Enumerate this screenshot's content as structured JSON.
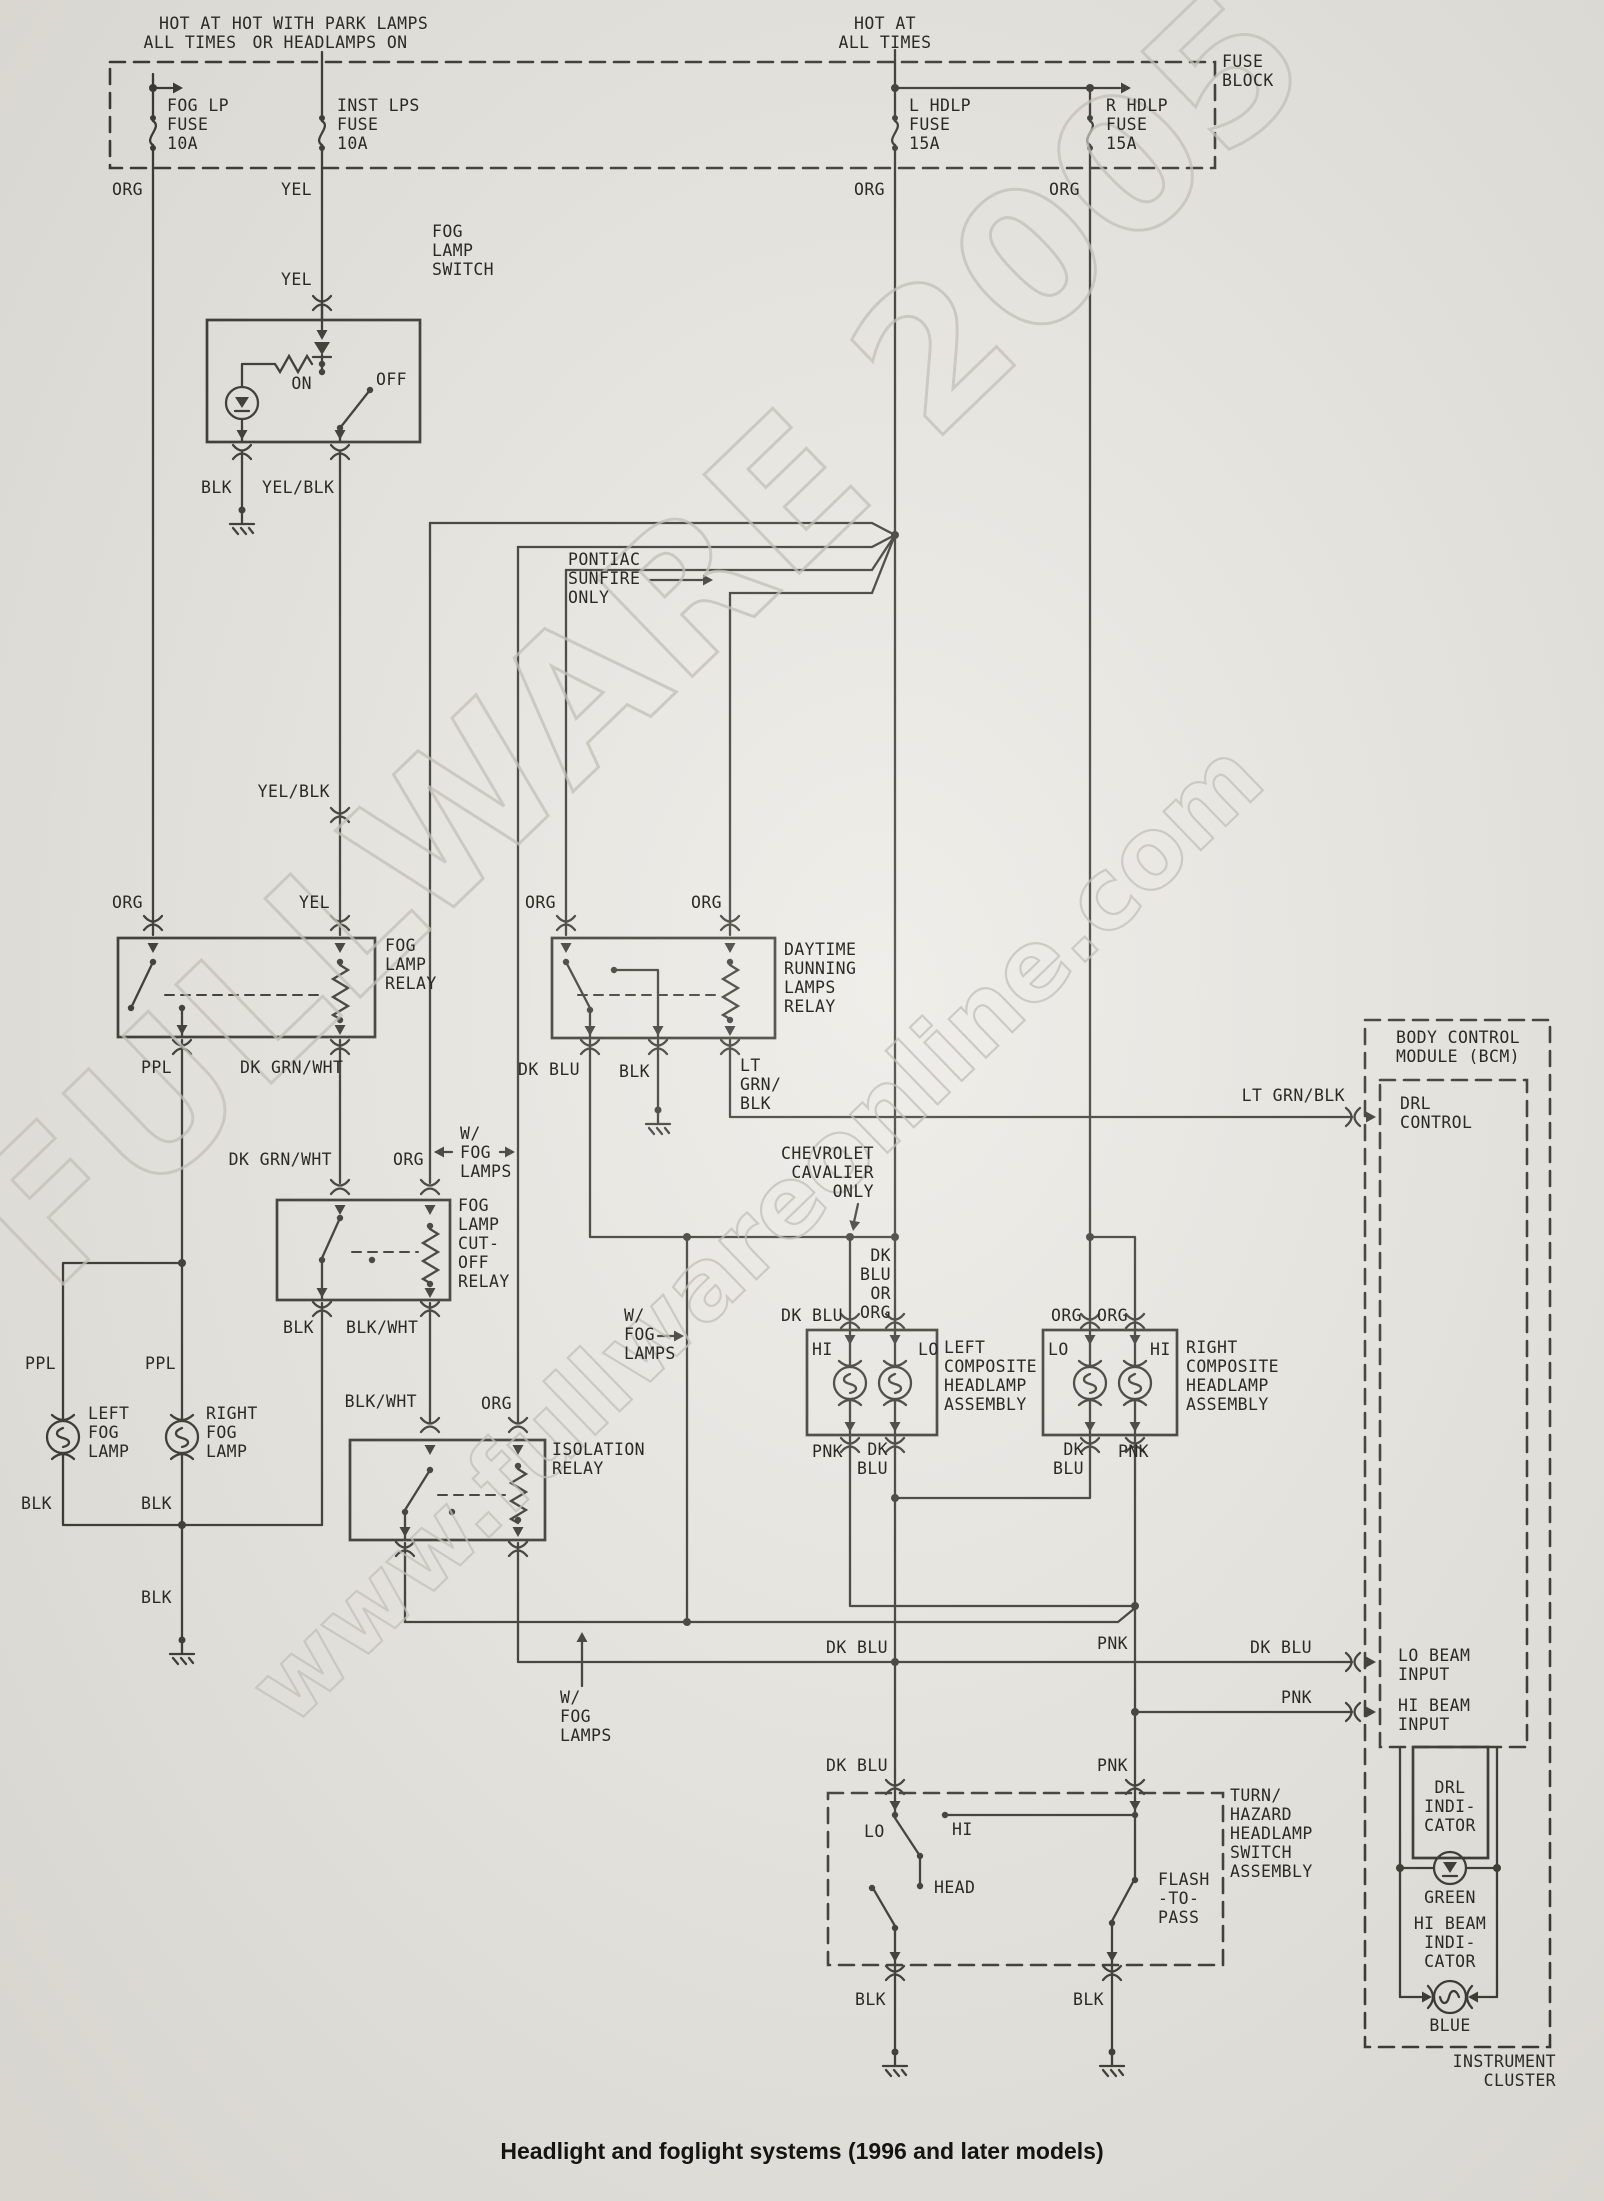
{
  "caption": "Headlight and foglight systems (1996 and later models)",
  "watermark": {
    "primary": "FULLWARE 2005",
    "secondary": "www.fullwareonline.com"
  },
  "colors": {
    "paper": "#eae8e2",
    "ink": "#26261f",
    "watermark": "#c2c1b8"
  },
  "labels": [
    {
      "t": "HOT AT\nALL TIMES",
      "x": 190,
      "y": 14,
      "a": "c"
    },
    {
      "t": "HOT WITH PARK LAMPS\nOR HEADLAMPS ON",
      "x": 330,
      "y": 14,
      "a": "c"
    },
    {
      "t": "HOT AT\nALL TIMES",
      "x": 885,
      "y": 14,
      "a": "c"
    },
    {
      "t": "FUSE\nBLOCK",
      "x": 1222,
      "y": 52,
      "a": "l"
    },
    {
      "t": "FOG LP\nFUSE\n10A",
      "x": 167,
      "y": 96,
      "a": "l"
    },
    {
      "t": "INST LPS\nFUSE\n10A",
      "x": 337,
      "y": 96,
      "a": "l"
    },
    {
      "t": "L HDLP\nFUSE\n15A",
      "x": 909,
      "y": 96,
      "a": "l"
    },
    {
      "t": "R HDLP\nFUSE\n15A",
      "x": 1106,
      "y": 96,
      "a": "l"
    },
    {
      "t": "ORG",
      "x": 143,
      "y": 180,
      "a": "r"
    },
    {
      "t": "YEL",
      "x": 312,
      "y": 180,
      "a": "r"
    },
    {
      "t": "ORG",
      "x": 885,
      "y": 180,
      "a": "r"
    },
    {
      "t": "ORG",
      "x": 1080,
      "y": 180,
      "a": "r"
    },
    {
      "t": "YEL",
      "x": 312,
      "y": 270,
      "a": "r"
    },
    {
      "t": "FOG\nLAMP\nSWITCH",
      "x": 432,
      "y": 222,
      "a": "l"
    },
    {
      "t": "ON",
      "x": 312,
      "y": 374,
      "a": "r"
    },
    {
      "t": "OFF",
      "x": 376,
      "y": 370,
      "a": "l"
    },
    {
      "t": "BLK",
      "x": 232,
      "y": 478,
      "a": "r"
    },
    {
      "t": "YEL/BLK",
      "x": 262,
      "y": 478,
      "a": "l"
    },
    {
      "t": "YEL/BLK",
      "x": 330,
      "y": 782,
      "a": "r"
    },
    {
      "t": "ORG",
      "x": 143,
      "y": 893,
      "a": "r"
    },
    {
      "t": "YEL",
      "x": 330,
      "y": 893,
      "a": "r"
    },
    {
      "t": "FOG\nLAMP\nRELAY",
      "x": 385,
      "y": 936,
      "a": "l"
    },
    {
      "t": "PPL",
      "x": 172,
      "y": 1058,
      "a": "r"
    },
    {
      "t": "DK GRN/WHT",
      "x": 240,
      "y": 1058,
      "a": "l"
    },
    {
      "t": "PONTIAC\nSUNFIRE\nONLY",
      "x": 568,
      "y": 550,
      "a": "l"
    },
    {
      "t": "ORG",
      "x": 556,
      "y": 893,
      "a": "r"
    },
    {
      "t": "ORG",
      "x": 722,
      "y": 893,
      "a": "r"
    },
    {
      "t": "DAYTIME\nRUNNING\nLAMPS\nRELAY",
      "x": 784,
      "y": 940,
      "a": "l"
    },
    {
      "t": "DK BLU",
      "x": 580,
      "y": 1060,
      "a": "r"
    },
    {
      "t": "BLK",
      "x": 650,
      "y": 1062,
      "a": "r"
    },
    {
      "t": "LT\nGRN/\nBLK",
      "x": 740,
      "y": 1056,
      "a": "l"
    },
    {
      "t": "LT GRN/BLK",
      "x": 1345,
      "y": 1086,
      "a": "r"
    },
    {
      "t": "DK GRN/WHT",
      "x": 332,
      "y": 1150,
      "a": "r"
    },
    {
      "t": "ORG",
      "x": 424,
      "y": 1150,
      "a": "r"
    },
    {
      "t": "W/\nFOG\nLAMPS",
      "x": 460,
      "y": 1124,
      "a": "l"
    },
    {
      "t": "FOG\nLAMP\nCUT-\nOFF\nRELAY",
      "x": 458,
      "y": 1196,
      "a": "l"
    },
    {
      "t": "BLK",
      "x": 314,
      "y": 1318,
      "a": "r"
    },
    {
      "t": "BLK/WHT",
      "x": 346,
      "y": 1318,
      "a": "l"
    },
    {
      "t": "BLK/WHT",
      "x": 417,
      "y": 1392,
      "a": "r"
    },
    {
      "t": "ORG",
      "x": 512,
      "y": 1394,
      "a": "r"
    },
    {
      "t": "ISOLATION\nRELAY",
      "x": 552,
      "y": 1440,
      "a": "l"
    },
    {
      "t": "PPL",
      "x": 56,
      "y": 1354,
      "a": "r"
    },
    {
      "t": "PPL",
      "x": 176,
      "y": 1354,
      "a": "r"
    },
    {
      "t": "LEFT\nFOG\nLAMP",
      "x": 88,
      "y": 1404,
      "a": "l"
    },
    {
      "t": "RIGHT\nFOG\nLAMP",
      "x": 206,
      "y": 1404,
      "a": "l"
    },
    {
      "t": "BLK",
      "x": 52,
      "y": 1494,
      "a": "r"
    },
    {
      "t": "BLK",
      "x": 172,
      "y": 1494,
      "a": "r"
    },
    {
      "t": "BLK",
      "x": 172,
      "y": 1588,
      "a": "r"
    },
    {
      "t": "W/\nFOG\nLAMPS",
      "x": 624,
      "y": 1306,
      "a": "l"
    },
    {
      "t": "CHEVROLET\nCAVALIER\nONLY",
      "x": 874,
      "y": 1144,
      "a": "r"
    },
    {
      "t": "DK\nBLU\nOR\nORG",
      "x": 891,
      "y": 1246,
      "a": "r"
    },
    {
      "t": "DK BLU",
      "x": 843,
      "y": 1306,
      "a": "r"
    },
    {
      "t": "HI",
      "x": 812,
      "y": 1340,
      "a": "l"
    },
    {
      "t": "LO",
      "x": 918,
      "y": 1340,
      "a": "l"
    },
    {
      "t": "LEFT\nCOMPOSITE\nHEADLAMP\nASSEMBLY",
      "x": 944,
      "y": 1338,
      "a": "l"
    },
    {
      "t": "PNK",
      "x": 843,
      "y": 1442,
      "a": "r"
    },
    {
      "t": "DK\nBLU",
      "x": 888,
      "y": 1440,
      "a": "r"
    },
    {
      "t": "ORG",
      "x": 1082,
      "y": 1306,
      "a": "r"
    },
    {
      "t": "ORG",
      "x": 1128,
      "y": 1306,
      "a": "r"
    },
    {
      "t": "LO",
      "x": 1048,
      "y": 1340,
      "a": "l"
    },
    {
      "t": "HI",
      "x": 1150,
      "y": 1340,
      "a": "l"
    },
    {
      "t": "RIGHT\nCOMPOSITE\nHEADLAMP\nASSEMBLY",
      "x": 1186,
      "y": 1338,
      "a": "l"
    },
    {
      "t": "DK\nBLU",
      "x": 1084,
      "y": 1440,
      "a": "r"
    },
    {
      "t": "PNK",
      "x": 1118,
      "y": 1442,
      "a": "l"
    },
    {
      "t": "DK BLU",
      "x": 888,
      "y": 1638,
      "a": "r"
    },
    {
      "t": "PNK",
      "x": 1128,
      "y": 1634,
      "a": "r"
    },
    {
      "t": "DK BLU",
      "x": 1312,
      "y": 1638,
      "a": "r"
    },
    {
      "t": "PNK",
      "x": 1312,
      "y": 1688,
      "a": "r"
    },
    {
      "t": "LO BEAM\nINPUT",
      "x": 1398,
      "y": 1646,
      "a": "l"
    },
    {
      "t": "HI BEAM\nINPUT",
      "x": 1398,
      "y": 1696,
      "a": "l"
    },
    {
      "t": "W/\nFOG\nLAMPS",
      "x": 560,
      "y": 1688,
      "a": "l"
    },
    {
      "t": "DK BLU",
      "x": 888,
      "y": 1756,
      "a": "r"
    },
    {
      "t": "PNK",
      "x": 1128,
      "y": 1756,
      "a": "r"
    },
    {
      "t": "LO",
      "x": 864,
      "y": 1822,
      "a": "l"
    },
    {
      "t": "HI",
      "x": 952,
      "y": 1820,
      "a": "l"
    },
    {
      "t": "HEAD",
      "x": 934,
      "y": 1878,
      "a": "l"
    },
    {
      "t": "FLASH\n-TO-\nPASS",
      "x": 1158,
      "y": 1870,
      "a": "l"
    },
    {
      "t": "TURN/\nHAZARD\nHEADLAMP\nSWITCH\nASSEMBLY",
      "x": 1230,
      "y": 1786,
      "a": "l"
    },
    {
      "t": "BLK",
      "x": 886,
      "y": 1990,
      "a": "r"
    },
    {
      "t": "BLK",
      "x": 1104,
      "y": 1990,
      "a": "r"
    },
    {
      "t": "BODY CONTROL\nMODULE (BCM)",
      "x": 1396,
      "y": 1028,
      "a": "l"
    },
    {
      "t": "DRL\nCONTROL",
      "x": 1400,
      "y": 1094,
      "a": "l"
    },
    {
      "t": "DRL\nINDI-\nCATOR",
      "x": 1450,
      "y": 1778,
      "a": "c"
    },
    {
      "t": "GREEN",
      "x": 1450,
      "y": 1888,
      "a": "c"
    },
    {
      "t": "HI BEAM\nINDI-\nCATOR",
      "x": 1450,
      "y": 1914,
      "a": "c"
    },
    {
      "t": "BLUE",
      "x": 1450,
      "y": 2016,
      "a": "c"
    },
    {
      "t": "INSTRUMENT\nCLUSTER",
      "x": 1556,
      "y": 2052,
      "a": "r"
    }
  ]
}
